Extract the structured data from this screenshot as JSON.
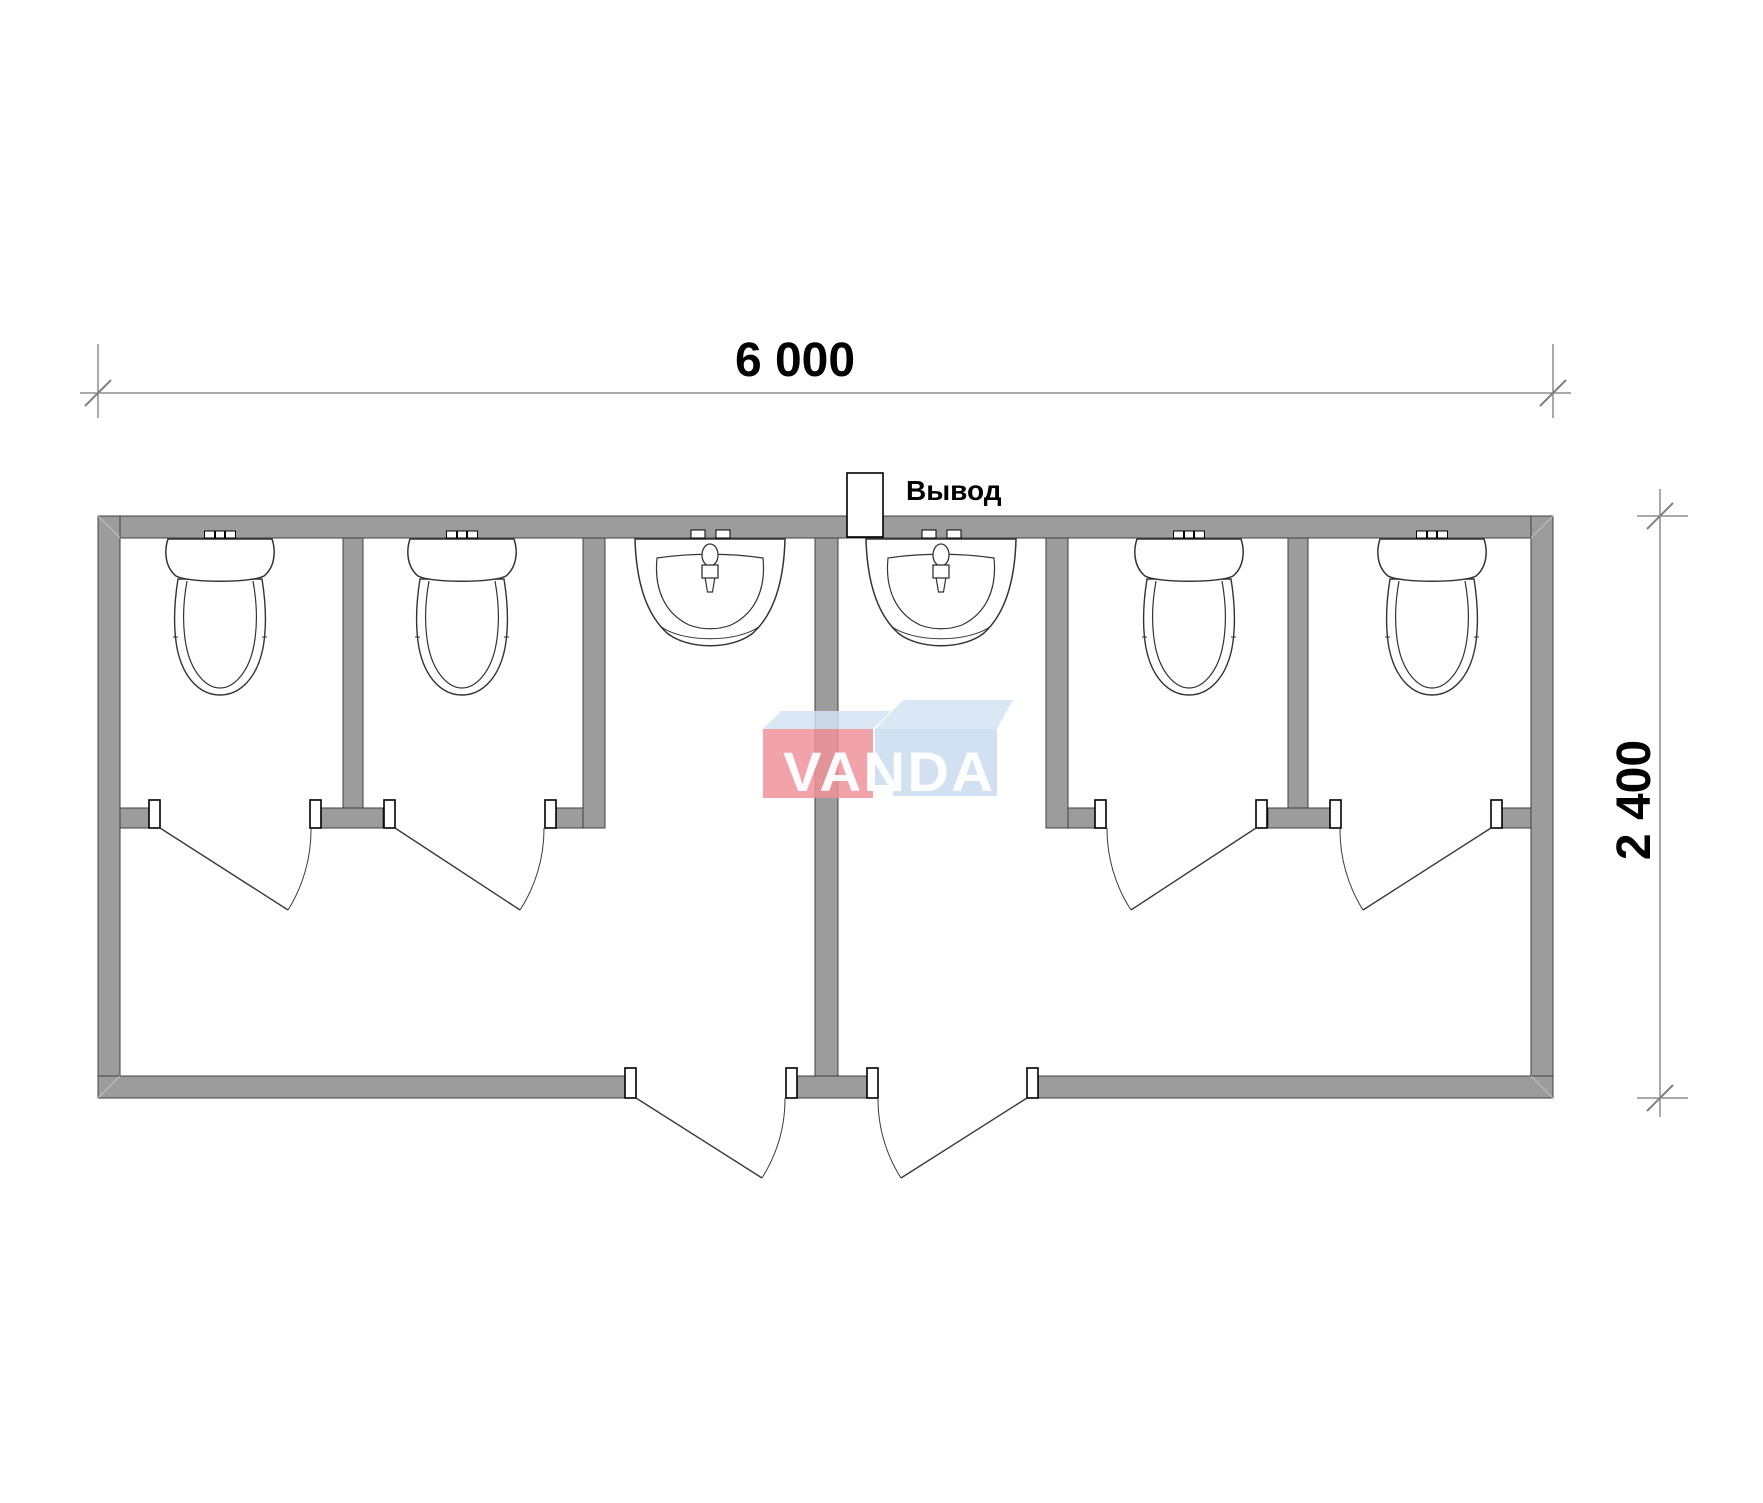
{
  "diagram": {
    "type": "floor-plan",
    "overall_width_mm": "6 000",
    "overall_depth_mm": "2 400"
  },
  "dimensions": {
    "width_label": "6 000",
    "height_label": "2 400"
  },
  "outlet": {
    "label": "Вывод",
    "position": "top-center"
  },
  "watermark": {
    "text": "VANDA"
  },
  "layout_facts": {
    "toilet_stalls": 4,
    "toilets": 4,
    "washbasins": 2,
    "stall_doors": 4,
    "entrance_doors": 2
  },
  "colors": {
    "wall_fill": "#9C9C9C",
    "wall_outline": "#3F3F3F",
    "fixture_stroke": "#333333",
    "dimension_line": "#555555",
    "tick_mark": "#808080",
    "text": "#000000",
    "logo_red": "#F0929A",
    "logo_blue": "#C6DAEE",
    "logo_top_face": "#D4E3F3",
    "background": "#FFFFFF"
  }
}
